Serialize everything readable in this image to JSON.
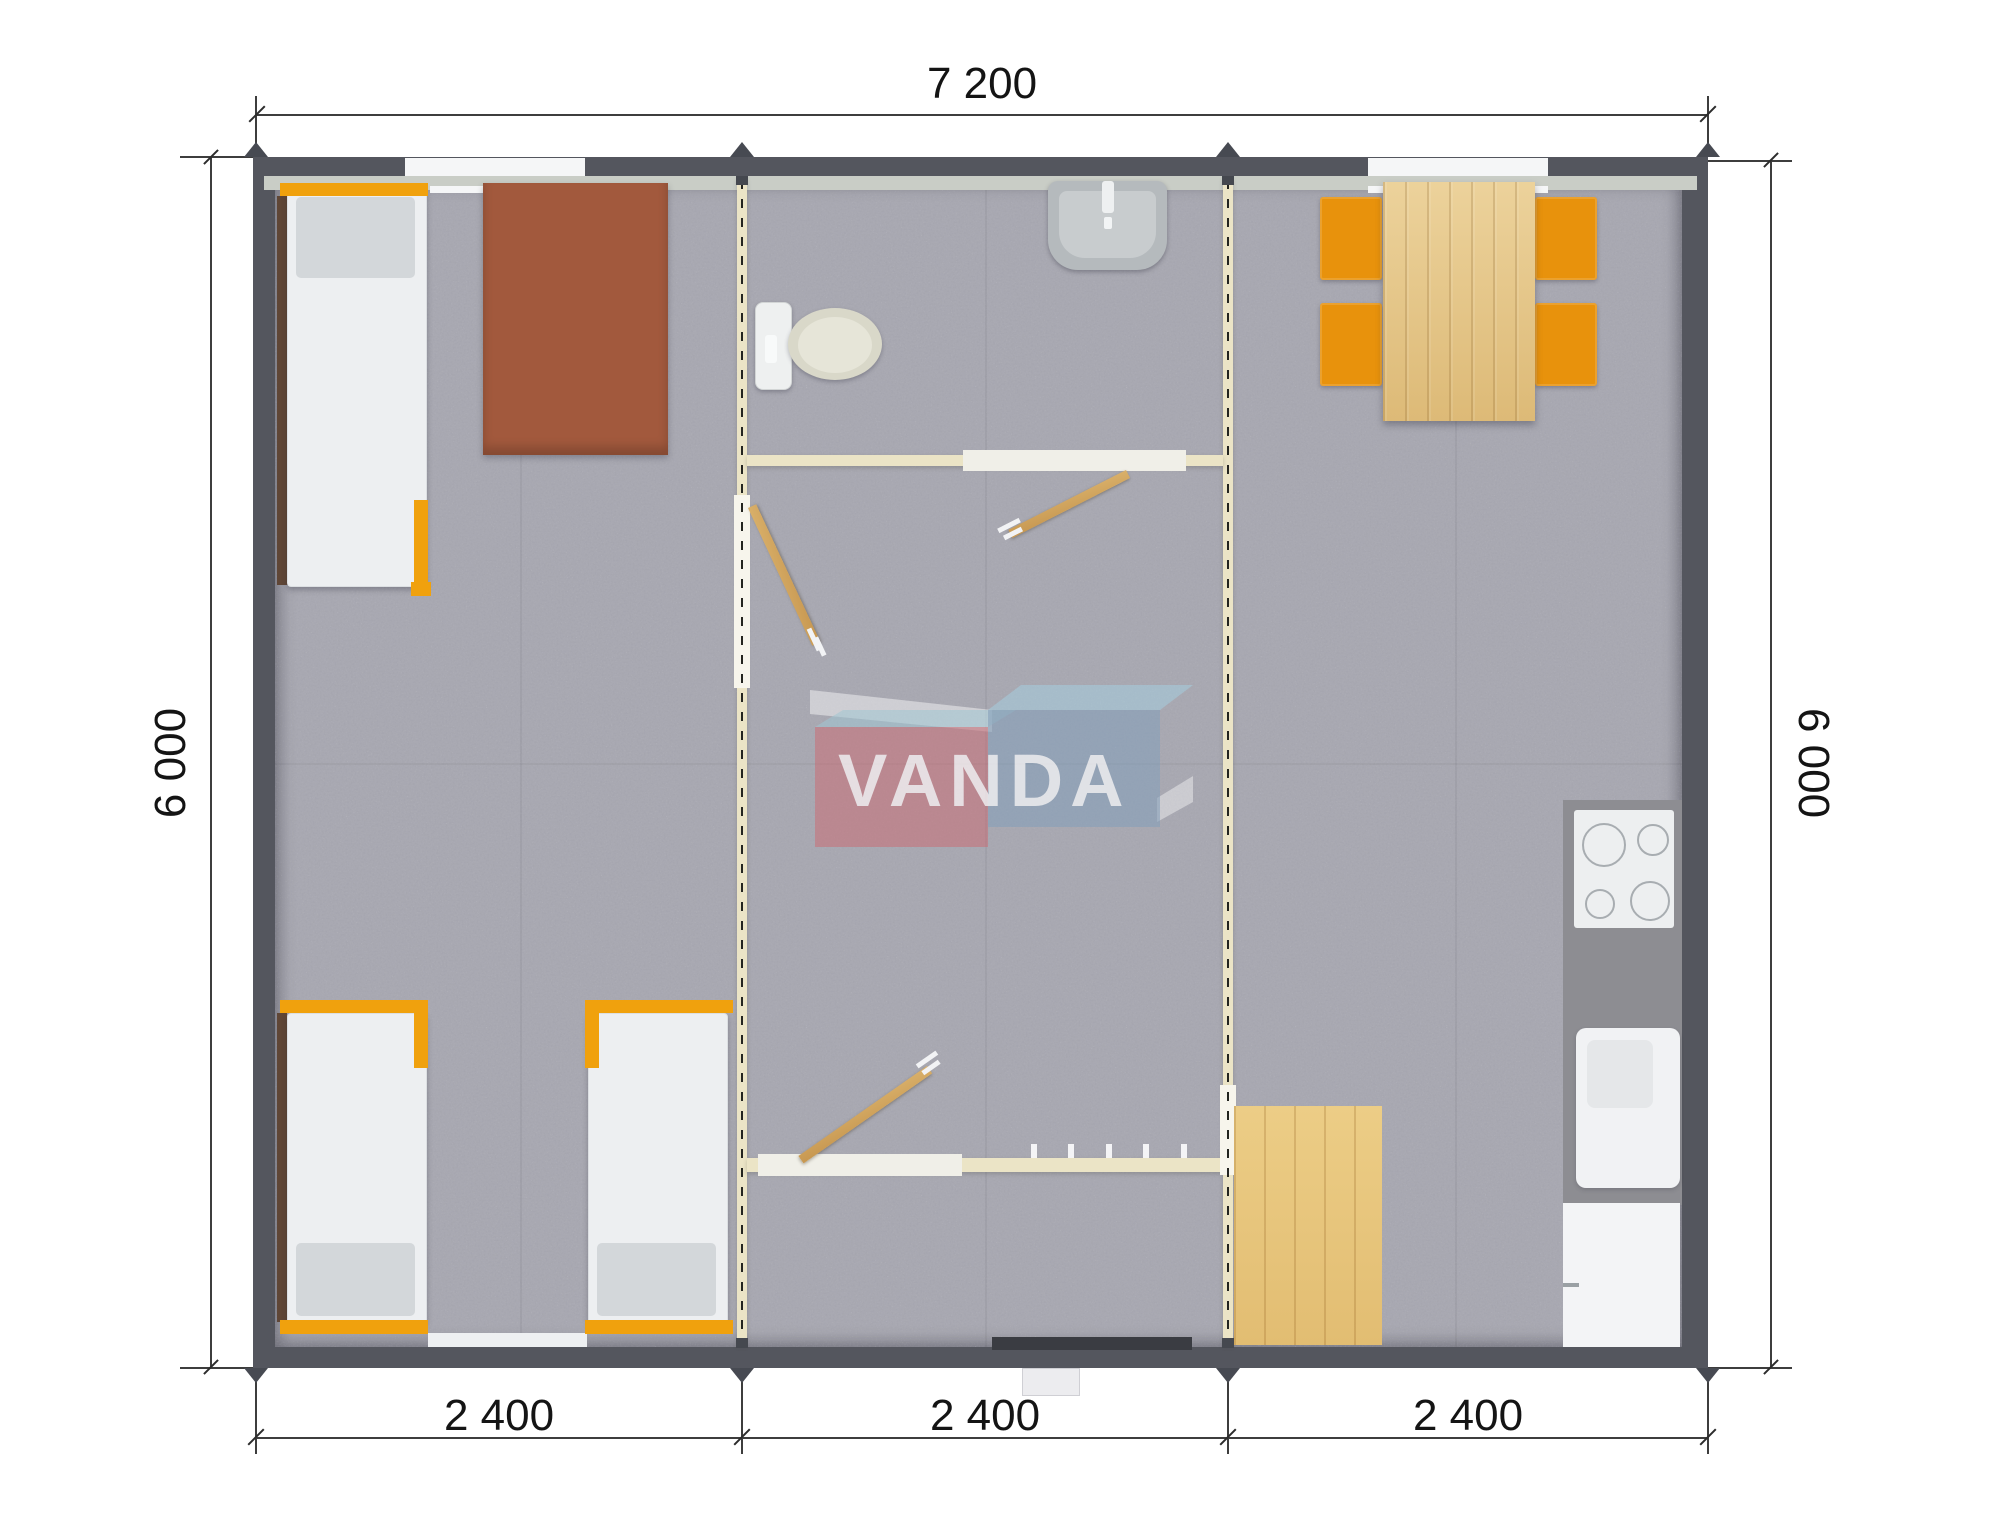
{
  "dimensions": {
    "top": "7 200",
    "left": "6 000",
    "right": "6 000",
    "bottom_segments": [
      "2 400",
      "2 400",
      "2 400"
    ]
  },
  "watermark": {
    "text": "VANDA"
  },
  "colors": {
    "outer_wall": "#54565e",
    "wall_liner": "#c9cdc6",
    "partition_cream": "#ebe4c6",
    "floor_gray": "#a9a9b2",
    "accent_orange": "#e8920c",
    "bed_frame_orange": "#f0a10d",
    "desk_brown": "#a2593d",
    "wood_light": "#e4c384",
    "logo_red": "#cf6670",
    "logo_blue": "#80a0bd"
  },
  "rooms": [
    "bedroom",
    "bathroom",
    "hallway",
    "entrance",
    "kitchen-dining"
  ],
  "furniture": [
    "single-bed",
    "single-bed",
    "single-bed",
    "desk",
    "toilet",
    "washbasin",
    "swing-door",
    "swing-door",
    "swing-door",
    "sliding-door",
    "sliding-door",
    "coat-hooks",
    "dining-table",
    "chair",
    "chair",
    "chair",
    "chair",
    "cooktop",
    "kitchen-counter",
    "kitchen-sink",
    "refrigerator",
    "wood-floor-mat",
    "entrance-step"
  ]
}
